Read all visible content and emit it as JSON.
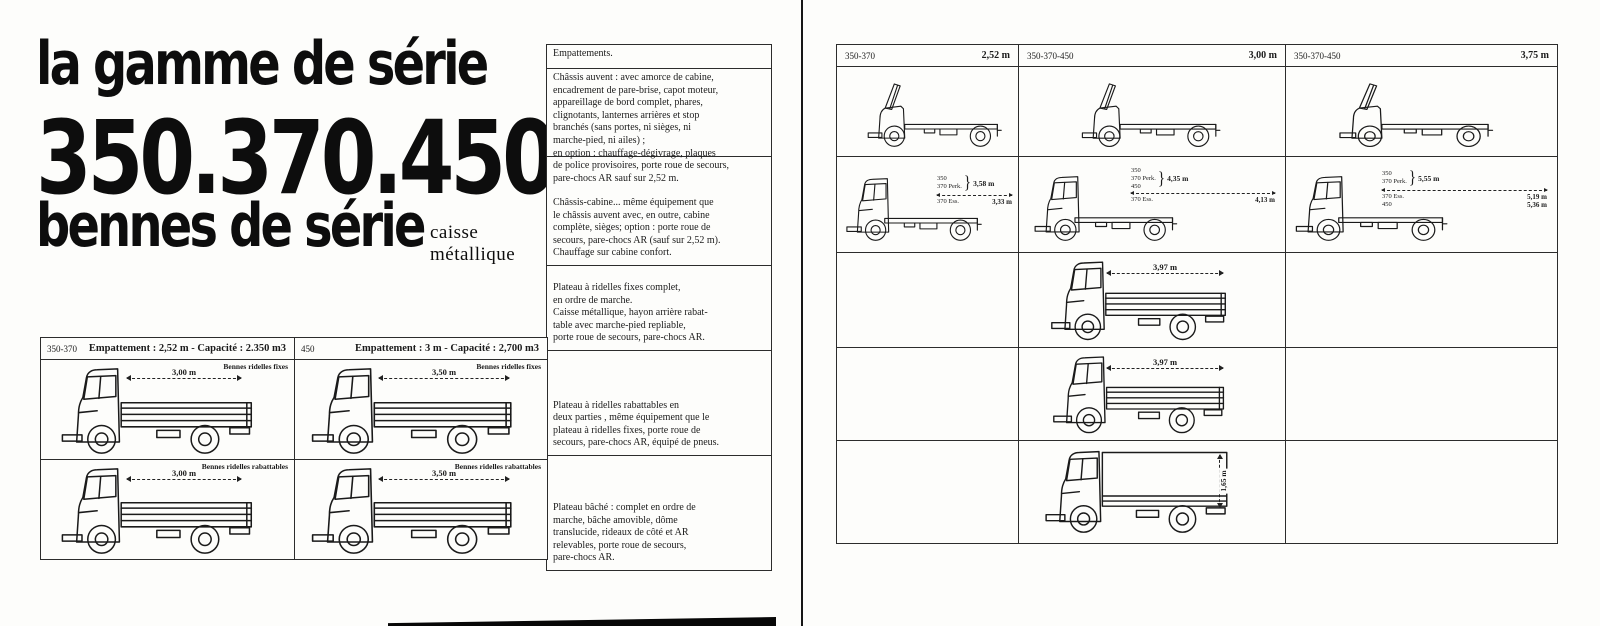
{
  "page_left": {
    "title": {
      "line1": "la gamme de série",
      "line2": "350.370.450",
      "line3": "bennes de série",
      "subtitle": "caisse métallique"
    },
    "specs": {
      "header": "Empattements.",
      "cells": [
        "Châssis auvent : avec amorce de cabine,\nencadrement de pare-brise, capot moteur,\nappareillage de bord complet, phares,\nclignotants, lanternes arrières et stop\nbranchés (sans portes, ni sièges, ni\nmarche-pied, ni ailes) ;\nen option : chauffage-dégivrage, plaques\nde police provisoires, porte roue de secours,\npare-chocs AR sauf sur 2,52 m.",
        "Châssis-cabine... même équipement que\nle châssis auvent avec, en outre, cabine\ncomplète, sièges; option : porte roue de\nsecours, pare-chocs AR (sauf sur 2,52 m).\nChauffage sur cabine confort.",
        "Plateau à ridelles fixes complet,\nen ordre de marche.\nCaisse métallique, hayon arrière rabat-\ntable avec marche-pied repliable,\nporte roue de secours, pare-chocs AR.",
        "Plateau à ridelles rabattables en\ndeux parties , même équipement que le\nplateau à ridelles fixes, porte roue de\nsecours, pare-chocs AR, équipé de pneus.",
        "Plateau bâché : complet en ordre de\nmarche, bâche amovible, dôme\ntranslucide, rideaux de côté et AR\nrelevables, porte roue de secours,\npare-chocs AR."
      ]
    },
    "table": {
      "columns": [
        {
          "model": "350-370",
          "spec": "Empattement : 2,52 m - Capacité : 2.350 m3",
          "rows": [
            {
              "caption": "Bennes ridelles fixes",
              "dim": "3,00 m"
            },
            {
              "caption": "Bennes ridelles rabattables",
              "dim": "3,00 m"
            }
          ]
        },
        {
          "model": "450",
          "spec": "Empattement : 3 m - Capacité : 2,700 m3",
          "rows": [
            {
              "caption": "Bennes ridelles fixes",
              "dim": "3,50 m"
            },
            {
              "caption": "Bennes ridelles rabattables",
              "dim": "3,50 m"
            }
          ]
        }
      ]
    }
  },
  "page_right": {
    "columns": [
      {
        "model": "350-370",
        "wheelbase": "2,52 m",
        "brace": "}",
        "cab_models": [
          "350",
          "370 Perk."
        ],
        "cab_value": "3,58 m",
        "cab_extra": [
          {
            "label": "370 Ess.",
            "value": "3,33 m"
          }
        ]
      },
      {
        "model": "350-370-450",
        "wheelbase": "3,00 m",
        "brace": "}",
        "cab_models": [
          "350",
          "370 Perk.",
          "450"
        ],
        "cab_value": "4,35 m",
        "cab_extra": [
          {
            "label": "370 Ess.",
            "value": "4,13 m"
          }
        ],
        "plateau_fixes_dim": "3,97 m",
        "plateau_rabattables_dim": "3,97 m",
        "bache_dim": "1,65 m"
      },
      {
        "model": "350-370-450",
        "wheelbase": "3,75 m",
        "brace": "}",
        "cab_models": [
          "350",
          "370 Perk."
        ],
        "cab_value": "5,55 m",
        "cab_extra": [
          {
            "label": "370 Ess.",
            "value": "5,19 m"
          },
          {
            "label": "450",
            "value": "5,36 m"
          }
        ]
      }
    ]
  }
}
